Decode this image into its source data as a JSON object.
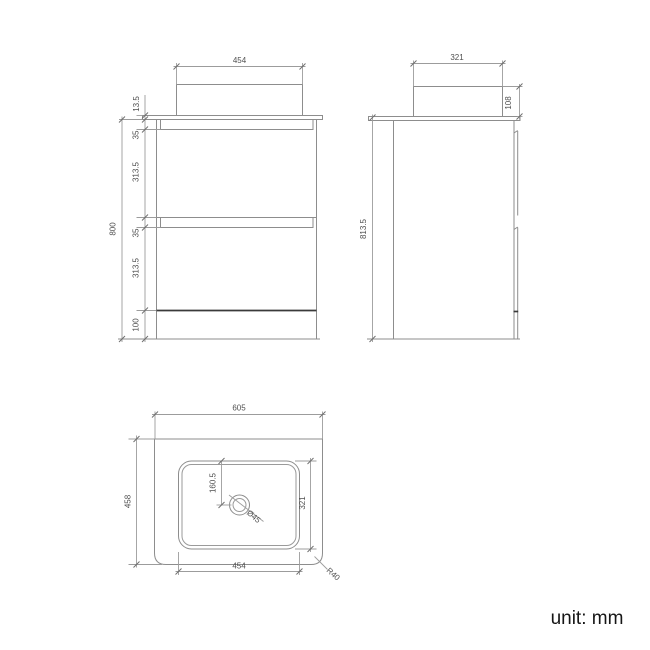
{
  "drawing": {
    "type": "technical-drawing",
    "subject": "floor-standing vanity unit with countertop basin",
    "views": [
      "front",
      "side",
      "plan"
    ]
  },
  "front_view": {
    "basin_width": "454",
    "countertop_thickness": "13.5",
    "top_recess_height": "35",
    "top_drawer_height": "313.5",
    "bottom_recess_height": "35",
    "bottom_drawer_height": "313.5",
    "plinth_height": "100",
    "overall_height": "800"
  },
  "side_view": {
    "basin_depth": "321",
    "basin_height": "108",
    "overall_height": "813.5"
  },
  "plan_view": {
    "countertop_width": "605",
    "countertop_depth": "458",
    "basin_width": "454",
    "basin_depth": "321",
    "tap_hole_offset": "160.5",
    "tap_hole_diameter": "Ø45",
    "corner_radius": "R40"
  },
  "footer": {
    "unit_label": "unit: mm"
  },
  "colors": {
    "background": "#ffffff",
    "line": "#8d8d8d",
    "dark_line": "#3a3a3a",
    "dimension_line": "#9c9c9c",
    "dimension_text": "#4f4f4f",
    "unit_text": "#161616"
  }
}
